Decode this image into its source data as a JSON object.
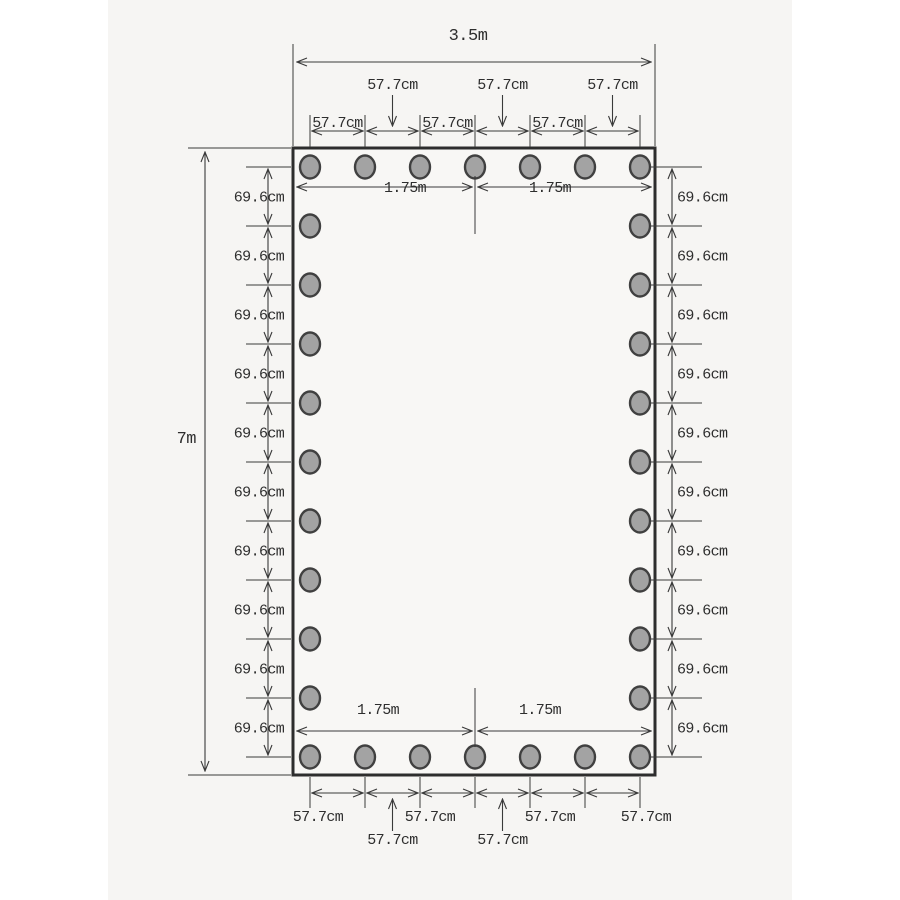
{
  "diagram": {
    "kind": "tarp-grommet-spacing-dimension-drawing",
    "overall": {
      "width": "3.5m",
      "height": "7m"
    },
    "spacing": {
      "horizontal_gap": "57.7cm",
      "vertical_gap": "69.6cm",
      "half_width": "1.75m"
    },
    "grommets": {
      "top_row": 7,
      "bottom_row": 7,
      "left_column": 11,
      "right_column": 11,
      "total": 32
    },
    "labels": {
      "top_inline": [
        "57.7cm",
        "57.7cm",
        "57.7cm"
      ],
      "top_leader": [
        "57.7cm",
        "57.7cm",
        "57.7cm"
      ],
      "bottom_inline": [
        "57.7cm",
        "57.7cm",
        "57.7cm",
        "57.7cm"
      ],
      "bottom_leader": [
        "57.7cm",
        "57.7cm"
      ],
      "left_segments": [
        "69.6cm",
        "69.6cm",
        "69.6cm",
        "69.6cm",
        "69.6cm",
        "69.6cm",
        "69.6cm",
        "69.6cm",
        "69.6cm",
        "69.6cm"
      ],
      "right_segments": [
        "69.6cm",
        "69.6cm",
        "69.6cm",
        "69.6cm",
        "69.6cm",
        "69.6cm",
        "69.6cm",
        "69.6cm",
        "69.6cm",
        "69.6cm"
      ],
      "top_half_spans": [
        "1.75m",
        "1.75m"
      ],
      "bottom_half_spans": [
        "1.75m",
        "1.75m"
      ]
    },
    "colors": {
      "page": "#ffffff",
      "paper": "#f6f5f3",
      "line": "#3a3a3a",
      "text": "#2e2e2e",
      "tarp_fill": "#f8f7f5",
      "tarp_border": "#2d2d2d",
      "grommet_fill": "#a3a3a3",
      "grommet_ring": "#404040"
    }
  }
}
